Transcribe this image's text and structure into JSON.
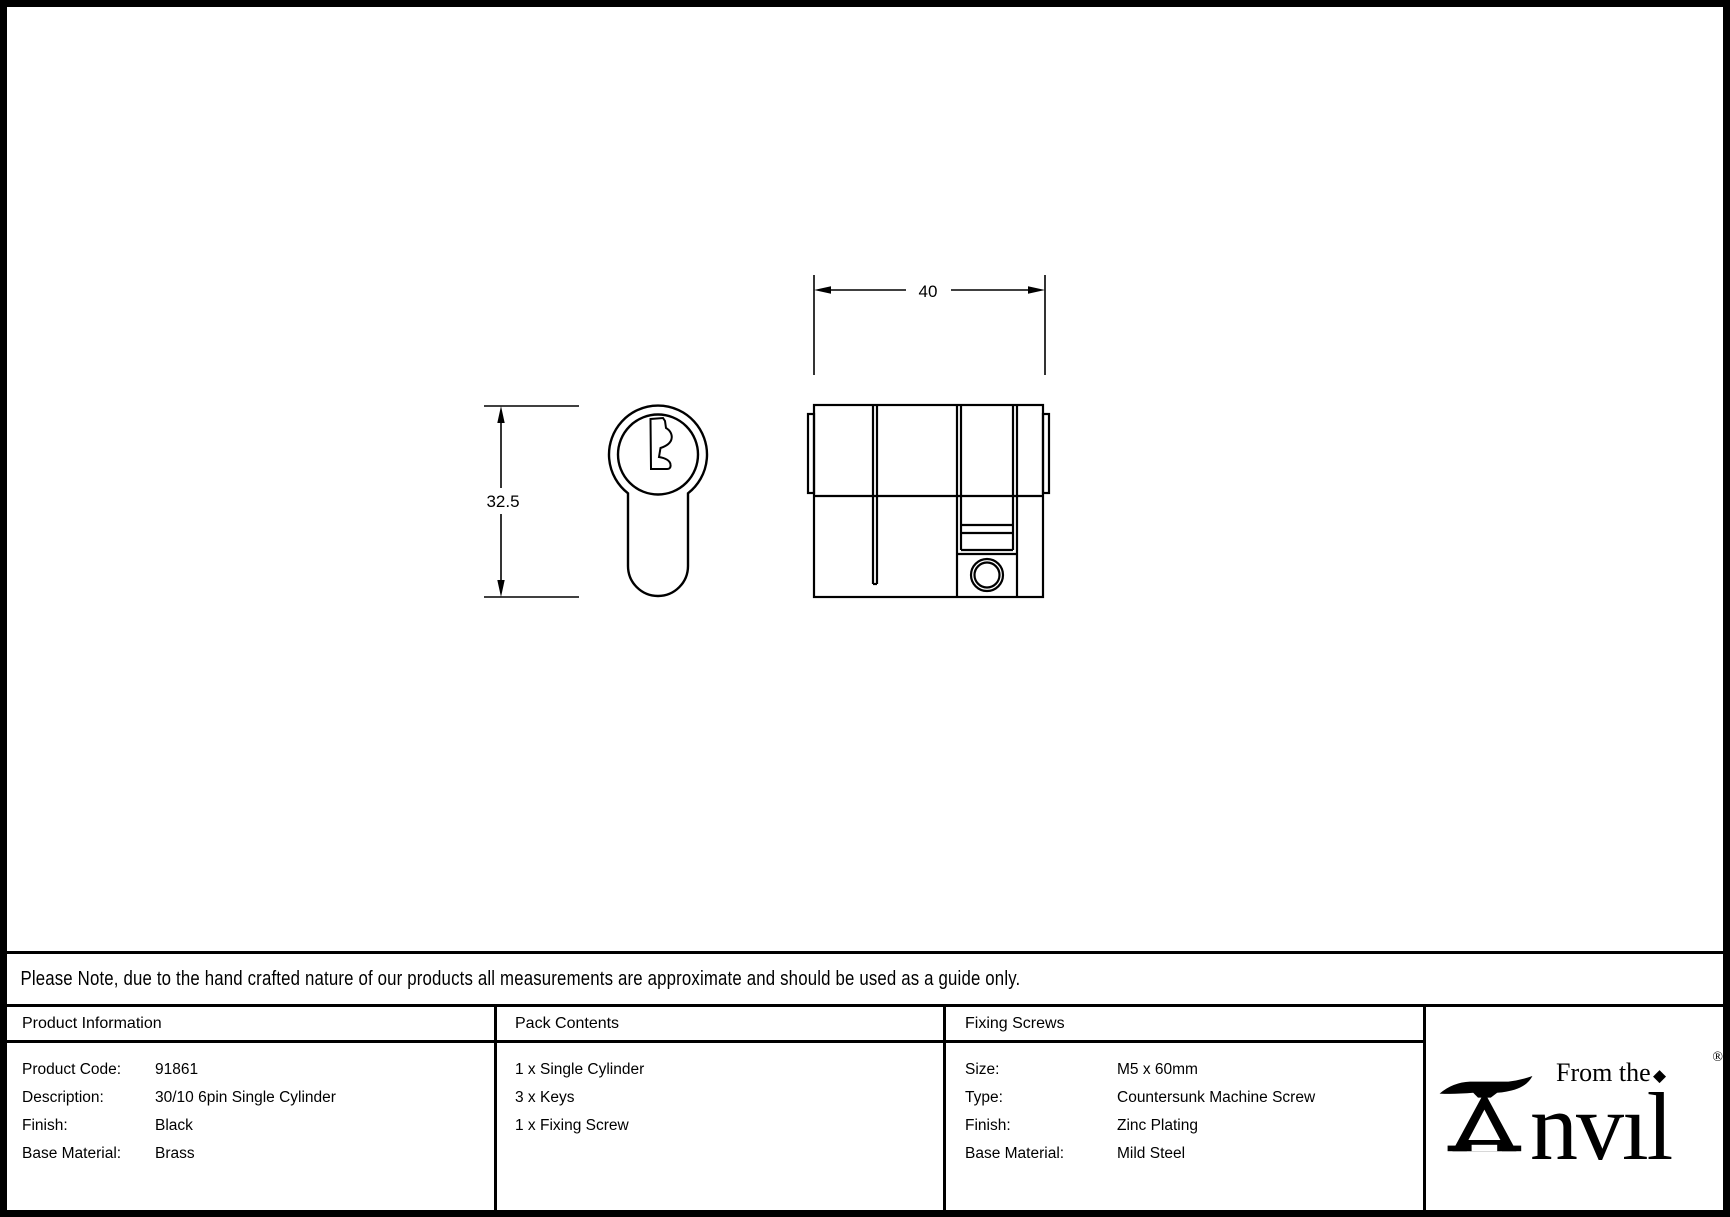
{
  "drawing": {
    "dim_width_label": "40",
    "dim_height_label": "32.5"
  },
  "note": {
    "text": "Please Note, due to the hand crafted nature of our products all measurements are approximate and should be used as a guide only."
  },
  "table": {
    "product_information": {
      "header": "Product Information",
      "rows": [
        {
          "label": "Product Code:",
          "value": "91861"
        },
        {
          "label": "Description:",
          "value": "30/10 6pin Single Cylinder"
        },
        {
          "label": "Finish:",
          "value": "Black"
        },
        {
          "label": "Base Material:",
          "value": "Brass"
        }
      ]
    },
    "pack_contents": {
      "header": "Pack Contents",
      "items": [
        "1 x Single Cylinder",
        "3 x Keys",
        "1 x Fixing Screw"
      ]
    },
    "fixing_screws": {
      "header": "Fixing Screws",
      "rows": [
        {
          "label": "Size:",
          "value": "M5 x 60mm"
        },
        {
          "label": "Type:",
          "value": "Countersunk Machine Screw"
        },
        {
          "label": "Finish:",
          "value": "Zinc Plating"
        },
        {
          "label": "Base Material:",
          "value": "Mild Steel"
        }
      ]
    }
  },
  "logo": {
    "brand": "Anvil",
    "brand_suffix": "nvıl",
    "prefix": "From the",
    "diamond": "◆",
    "registered": "®"
  },
  "colors": {
    "ink": "#000000",
    "background": "#ffffff"
  }
}
